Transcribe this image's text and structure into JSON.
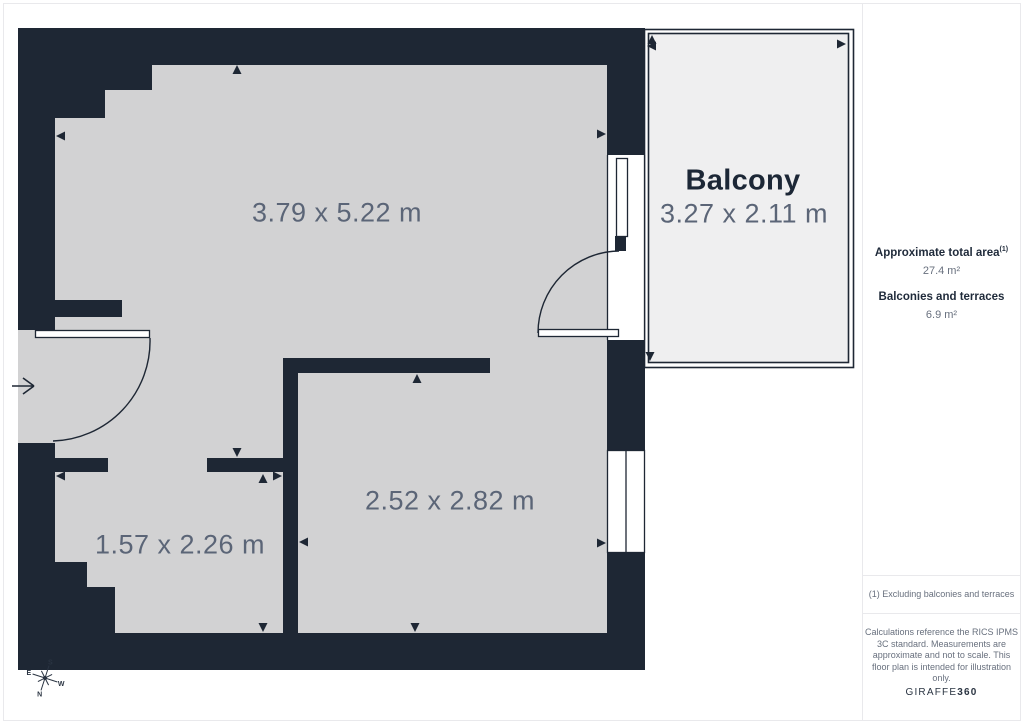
{
  "floor_plan": {
    "rooms": [
      {
        "id": "main-room",
        "dimensions": "3.79 x 5.22 m"
      },
      {
        "id": "bottom-right-room",
        "dimensions": "2.52 x 2.82 m"
      },
      {
        "id": "bottom-left-room",
        "dimensions": "1.57 x 2.26 m"
      }
    ],
    "balcony": {
      "label": "Balcony",
      "dimensions": "3.27 x 2.11 m"
    },
    "compass": {
      "north": "N",
      "south": "S",
      "east": "E",
      "west": "W"
    }
  },
  "sidebar": {
    "total_area_label": "Approximate total area",
    "total_area_footnote_marker": "(1)",
    "total_area_value": "27.4 m²",
    "balconies_label": "Balconies and terraces",
    "balconies_value": "6.9 m²",
    "footnote": "(1) Excluding balconies and terraces",
    "disclaimer": "Calculations reference the RICS IPMS 3C standard. Measurements are approximate and not to scale. This floor plan is intended for illustration only.",
    "brand_name": "GIRAFFE",
    "brand_number": "360"
  },
  "colors": {
    "wall": "#1e2734",
    "floor": "#d2d2d3",
    "balcony_floor": "#efeff0",
    "dimension_text": "#5b6577",
    "heading_text": "#1f2a3a",
    "muted_text": "#68707e",
    "divider": "#e9e9ec"
  }
}
